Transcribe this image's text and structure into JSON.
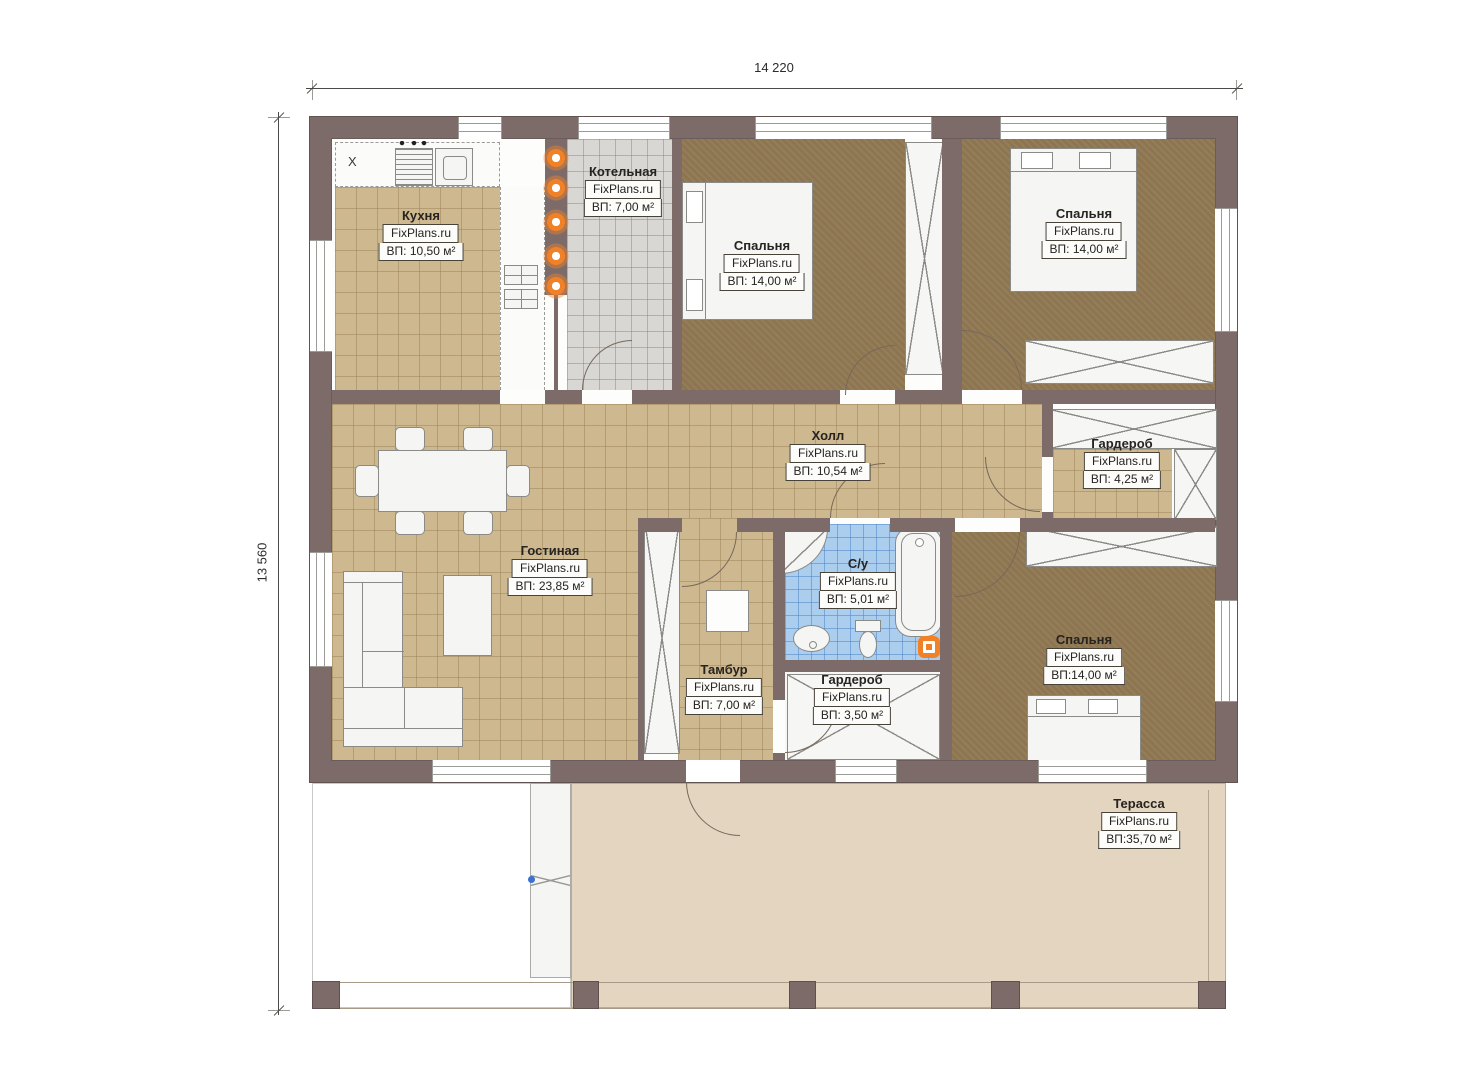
{
  "dimensions": {
    "top": "14 220",
    "left": "13 560"
  },
  "rooms": {
    "kitchen": {
      "name": "Кухня",
      "brand": "FixPlans.ru",
      "area": "ВП: 10,50 м²"
    },
    "boiler": {
      "name": "Котельная",
      "brand": "FixPlans.ru",
      "area": "ВП: 7,00 м²"
    },
    "bedroom_top_middle": {
      "name": "Спальня",
      "brand": "FixPlans.ru",
      "area": "ВП: 14,00 м²"
    },
    "bedroom_top_right": {
      "name": "Спальня",
      "brand": "FixPlans.ru",
      "area": "ВП: 14,00 м²"
    },
    "hall": {
      "name": "Холл",
      "brand": "FixPlans.ru",
      "area": "ВП: 10,54 м²"
    },
    "wardrobe_right": {
      "name": "Гардероб",
      "brand": "FixPlans.ru",
      "area": "ВП: 4,25 м²"
    },
    "living": {
      "name": "Гостиная",
      "brand": "FixPlans.ru",
      "area": "ВП: 23,85 м²"
    },
    "vestibule": {
      "name": "Тамбур",
      "brand": "FixPlans.ru",
      "area": "ВП: 7,00 м²"
    },
    "bathroom": {
      "name": "С/у",
      "brand": "FixPlans.ru",
      "area": "ВП: 5,01 м²"
    },
    "wardrobe_small": {
      "name": "Гардероб",
      "brand": "FixPlans.ru",
      "area": "ВП: 3,50 м²"
    },
    "bedroom_bottom": {
      "name": "Спальня",
      "brand": "FixPlans.ru",
      "area": "ВП:14,00 м²"
    },
    "terrace": {
      "name": "Терасса",
      "brand": "FixPlans.ru",
      "area": "ВП:35,70 м²"
    }
  },
  "symbols": {
    "fridge": "X"
  },
  "colors": {
    "wall": "#7d6b6a",
    "floor_tan": "#cdb88f",
    "floor_brown": "#8d7550",
    "floor_gray": "#d9d7d4",
    "floor_blue": "#abcdee",
    "terrace": "#e3d5c0",
    "accent_orange": "#f08127"
  }
}
